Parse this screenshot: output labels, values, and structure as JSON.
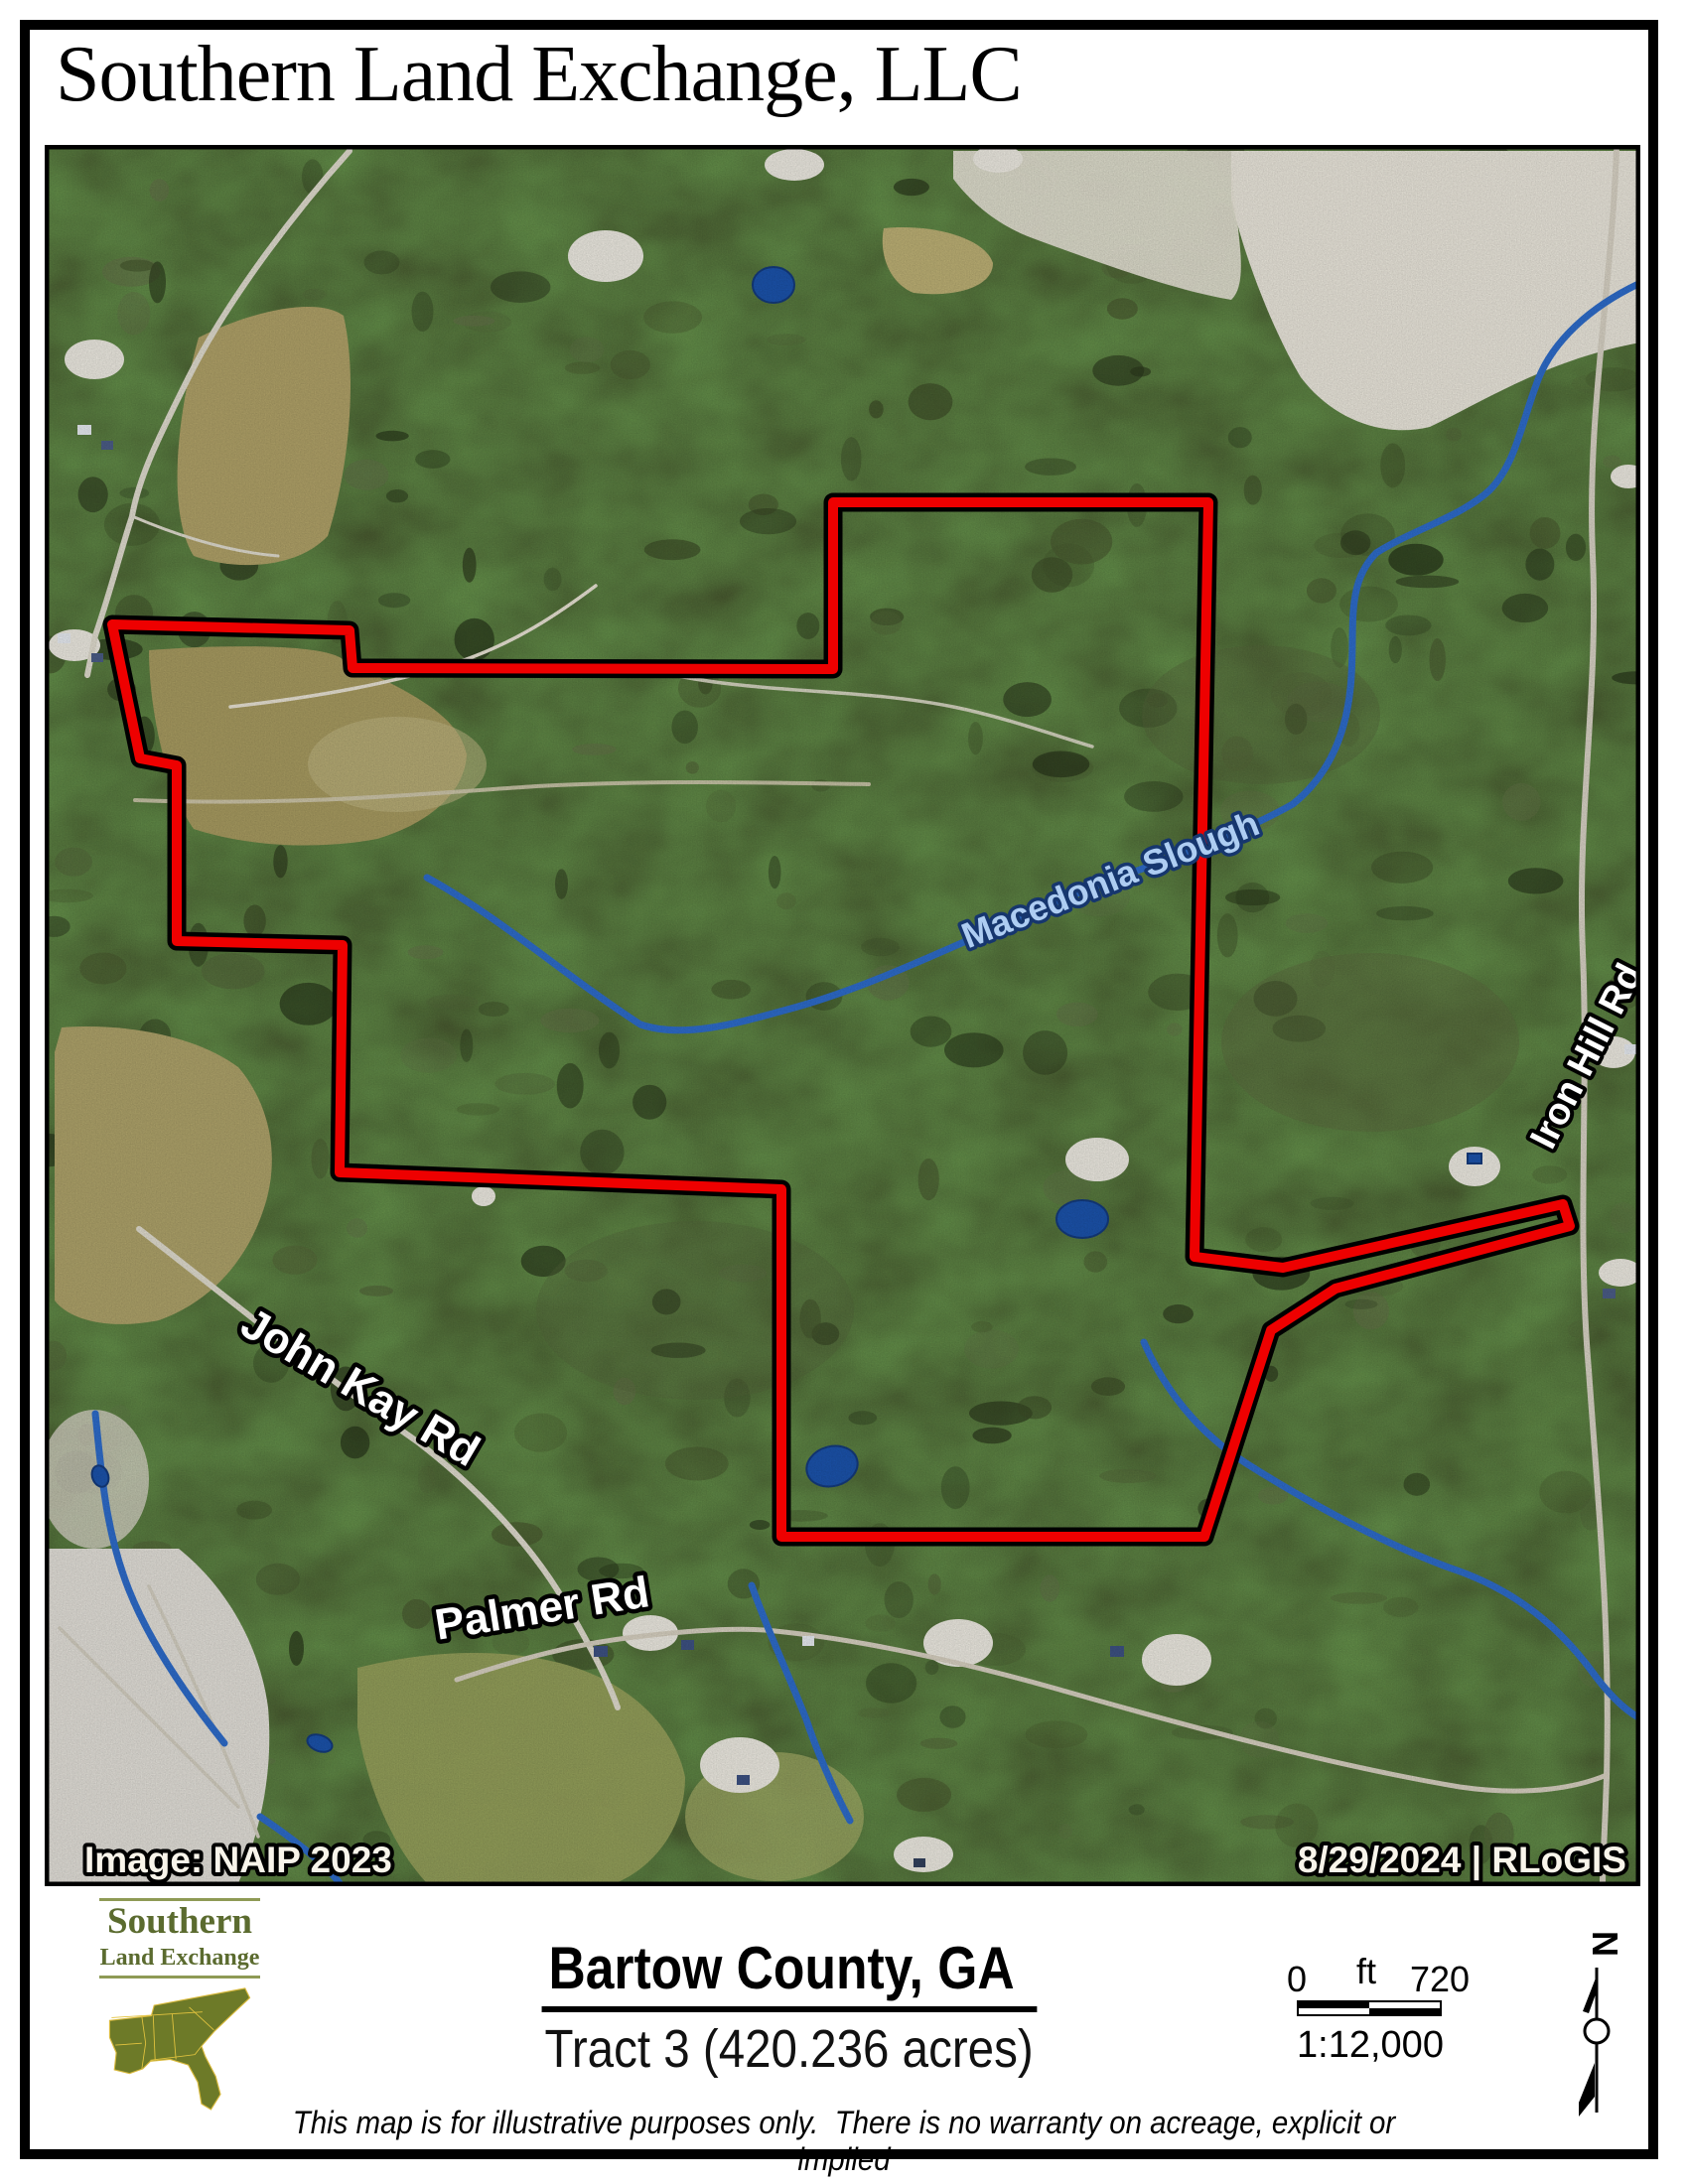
{
  "page": {
    "title": "Southern Land Exchange, LLC"
  },
  "map": {
    "labels": {
      "stream": "Macedonia Slough",
      "road_right": "Iron Hill Rd",
      "road_left": "John Kay Rd",
      "road_bottom": "Palmer Rd",
      "imagery_credit": "Image: NAIP 2023",
      "date_credit": "8/29/2024 | RLoGIS"
    }
  },
  "footer": {
    "logo": {
      "line1": "Southern",
      "line2": "Land Exchange"
    },
    "county": "Bartow County, GA",
    "tract": "Tract 3 (420.236 acres)",
    "scale": {
      "zero": "0",
      "unit": "ft",
      "max": "720",
      "ratio": "1:12,000"
    },
    "north_letter": "N",
    "disclaimer": "This map is for illustrative purposes only.  There is no warranty on acreage, explicit or implied"
  },
  "colors": {
    "boundary_red": "#ee0000",
    "boundary_casing": "#000000",
    "stream_blue": "#2f6fd0",
    "stream_label_fill": "#aecdf2",
    "stream_label_halo": "#16366e",
    "logo_green": "#5b6b2f",
    "forest_green": "#45532c"
  }
}
